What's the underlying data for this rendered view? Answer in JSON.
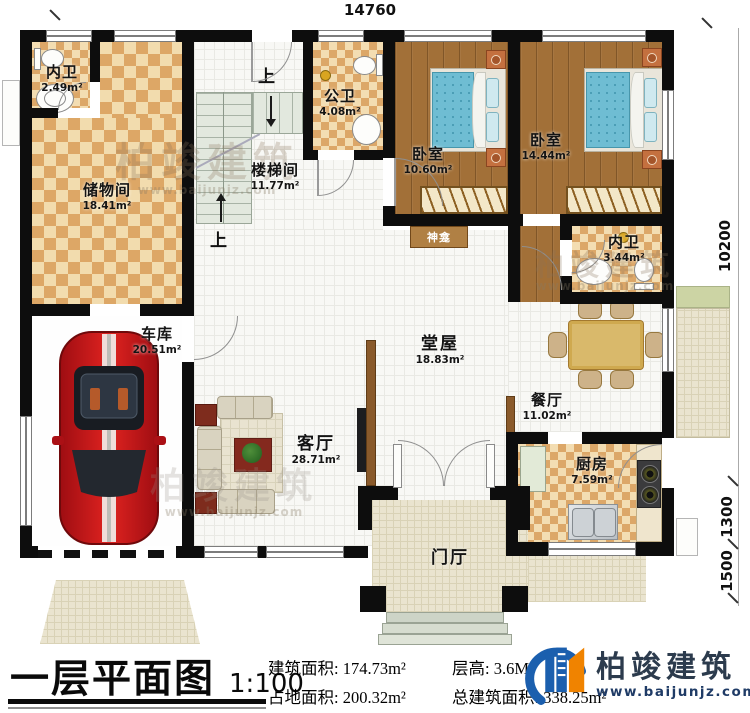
{
  "dims": {
    "top": "14760",
    "total": "10200",
    "porch": "1300",
    "terrace": "1500"
  },
  "stairs": {
    "up": "上"
  },
  "rooms": {
    "neiwei1": {
      "name": "内卫",
      "area": "2.49m²"
    },
    "chuwu": {
      "name": "储物间",
      "area": "18.41m²"
    },
    "cheku": {
      "name": "车库",
      "area": "20.51m²"
    },
    "louti": {
      "name": "楼梯间",
      "area": "11.77m²"
    },
    "gongwei": {
      "name": "公卫",
      "area": "4.08m²"
    },
    "woshi1": {
      "name": "卧室",
      "area": "10.60m²"
    },
    "woshi2": {
      "name": "卧室",
      "area": "14.44m²"
    },
    "neiwei2": {
      "name": "内卫",
      "area": "3.44m²"
    },
    "tangwu": {
      "name": "堂屋",
      "area": "18.83m²"
    },
    "canting": {
      "name": "餐厅",
      "area": "11.02m²"
    },
    "keting": {
      "name": "客厅",
      "area": "28.71m²"
    },
    "chufang": {
      "name": "厨房",
      "area": "7.59m²"
    },
    "menting": {
      "name": "门厅"
    },
    "shenkan": {
      "name": "神龛"
    }
  },
  "footer": {
    "title": "一层平面图",
    "scale": "1:100",
    "stats": {
      "jzmj_label": "建筑面积:",
      "jzmj": "174.73m²",
      "cg_label": "层高:",
      "cg": "3.6M",
      "zdmj_label": "占地面积:",
      "zdmj": "200.32m²",
      "zjzmj_label": "总建筑面积:",
      "zjzmj": "338.25m²"
    },
    "brand": {
      "name": "柏竣建筑",
      "site": "www.baijunjz.com"
    }
  },
  "watermark": {
    "name": "柏竣建筑",
    "site": "www.baijunjz.com"
  }
}
